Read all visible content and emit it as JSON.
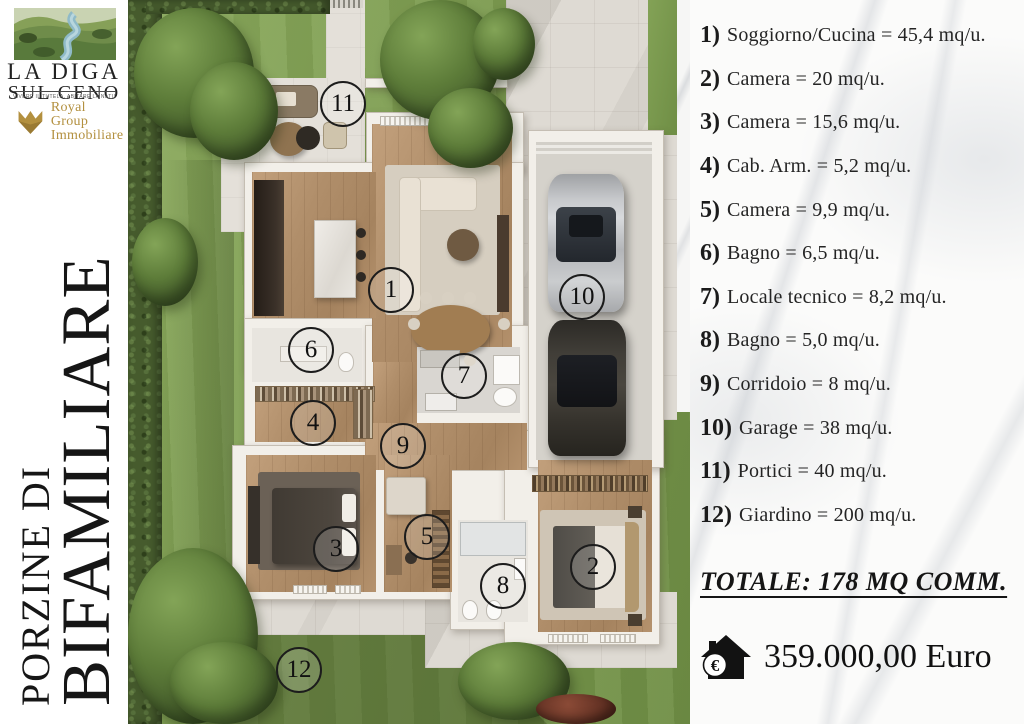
{
  "branding": {
    "logo_title_line1": "LA DIGA",
    "logo_title_line2": "SUL CENO",
    "tagline": "VIVERE IL TUTELA, ABITARE LA NATURA",
    "agency_line1": "Royal Group",
    "agency_line2": "Immobiliare",
    "gold": "#b3903f"
  },
  "side_title": {
    "line1": "PORZINE DI",
    "line2": "BIFAMILIARE"
  },
  "floor_plan": {
    "unit_labels": [
      "1",
      "2",
      "3",
      "4",
      "5",
      "6",
      "7",
      "8",
      "9",
      "10",
      "11",
      "12"
    ]
  },
  "info_panel": {
    "items": [
      {
        "num": "1)",
        "text": "Soggiorno/Cucina = 45,4 mq/u."
      },
      {
        "num": "2)",
        "text": "Camera = 20 mq/u."
      },
      {
        "num": "3)",
        "text": "Camera = 15,6 mq/u."
      },
      {
        "num": "4)",
        "text": "Cab. Arm. = 5,2 mq/u."
      },
      {
        "num": "5)",
        "text": "Camera = 9,9 mq/u."
      },
      {
        "num": "6)",
        "text": "Bagno = 6,5 mq/u."
      },
      {
        "num": "7)",
        "text": "Locale tecnico = 8,2 mq/u."
      },
      {
        "num": "8)",
        "text": "Bagno = 5,0 mq/u."
      },
      {
        "num": "9)",
        "text": "Corridoio = 8 mq/u."
      },
      {
        "num": "10)",
        "text": "Garage = 38 mq/u."
      },
      {
        "num": "11)",
        "text": "Portici = 40 mq/u."
      },
      {
        "num": "12)",
        "text": "Giardino = 200 mq/u."
      }
    ],
    "total_line": "TOTALE: 178 MQ COMM.",
    "price": "359.000,00 Euro",
    "euro_symbol": "€"
  },
  "colors": {
    "grass": "#7d9c50",
    "pavement": "#dedad3",
    "wall": "#f2efe9",
    "wood": "#b08e6a",
    "hedge": "#465b2d",
    "gold": "#b3903f",
    "text": "#1b1b1b"
  }
}
